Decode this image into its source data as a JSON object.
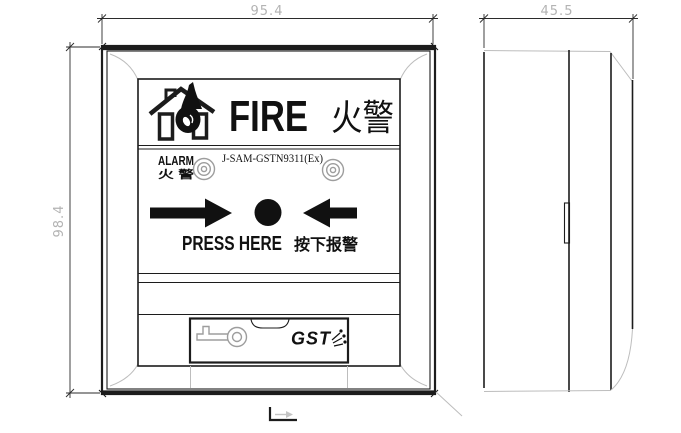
{
  "drawing": {
    "title": "manual-fire-call-point-dimension-drawing",
    "dimensions": {
      "front_width_mm": "95.4",
      "front_height_mm": "98.4",
      "side_depth_mm": "45.5"
    },
    "front_view": {
      "header": {
        "fire_en": "FIRE",
        "fire_zh": "火警"
      },
      "alarm_row": {
        "alarm_en": "ALARM",
        "alarm_zh": "火 警",
        "model": "J-SAM-GSTN9311(Ex)"
      },
      "press_row": {
        "press_en": "PRESS HERE",
        "press_zh": "按下报警"
      },
      "bottom": {
        "brand": "GST"
      }
    },
    "icons": {
      "header_icon": "house-flame-icon",
      "led_indicators": "concentric-circle-led",
      "button": "press-button-circle",
      "arrows": "inward-arrows",
      "key": "key-icon",
      "datum": "l-datum-mark"
    },
    "colors": {
      "ink": "#1c1c1c",
      "dim_text": "#b3b3b3",
      "light_line": "#bdbdbd",
      "key_line": "#9d9d9d",
      "background": "#ffffff"
    }
  }
}
